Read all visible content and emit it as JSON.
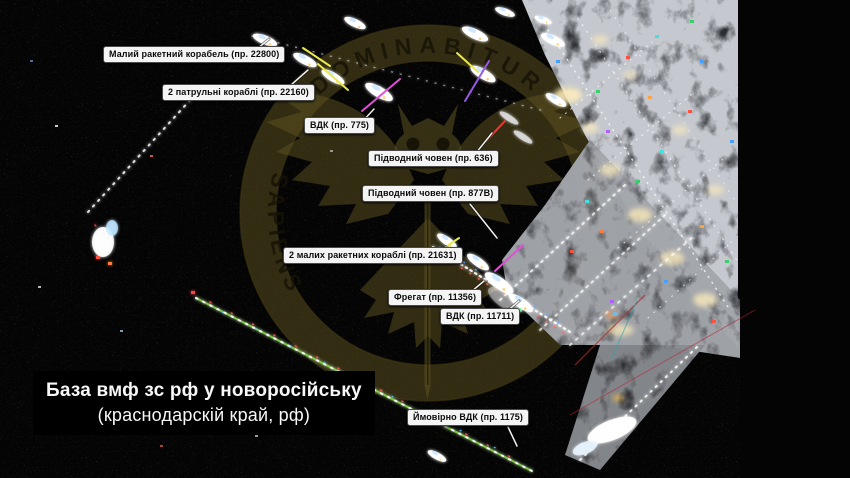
{
  "image_title": {
    "line1": "База вмф зс рф у новоросійську",
    "line2": "(краснодарскій край, рф)"
  },
  "watermark": {
    "arc_text_top": "DOMINABITUR",
    "arc_text_left": "SAPIENS"
  },
  "ship_labels": [
    {
      "text": "Малий ракетний корабель (пр. 22800)"
    },
    {
      "text": "2 патрульні кораблі (пр. 22160)"
    },
    {
      "text": "ВДК (пр. 775)"
    },
    {
      "text": "Підводний човен (пр. 636)"
    },
    {
      "text": "Підводний човен (пр. 877В)"
    },
    {
      "text": "2 малих ракетних кораблі (пр. 21631)"
    },
    {
      "text": "Фрегат (пр. 11356)"
    },
    {
      "text": "ВДК (пр. 11711)"
    },
    {
      "text": "Ймовірно ВДК (пр. 1175)"
    }
  ],
  "colors": {
    "highlight_yellow": "#e9e94e",
    "highlight_magenta": "#e14fd8",
    "highlight_purple": "#9a58e8",
    "highlight_red": "#e03a3a",
    "breakwater_green": "#8bd94e",
    "watermark_olive": "#5f5320",
    "label_background": "#f4f4f4",
    "leader_line": "#f0f0f0"
  }
}
